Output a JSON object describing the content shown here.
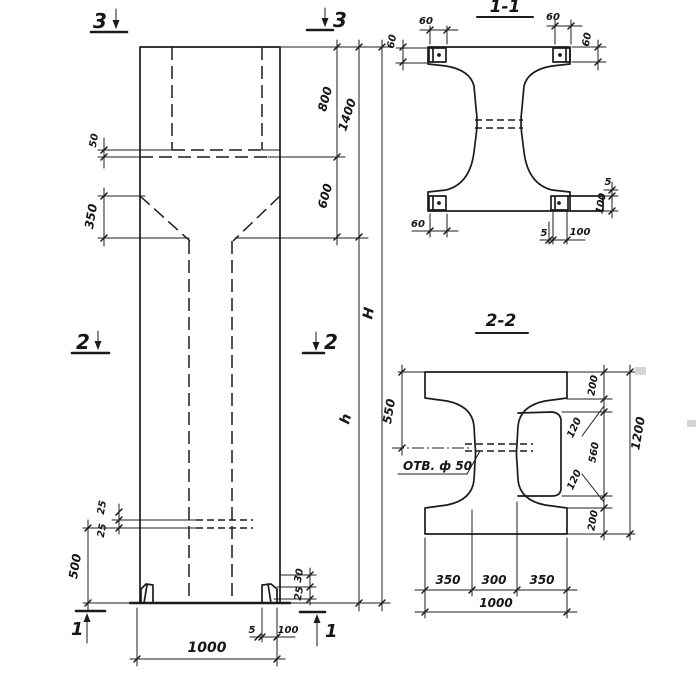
{
  "mv": {
    "m3l": "3",
    "m3r": "3",
    "m2l": "2",
    "m2r": "2",
    "m1l": "1",
    "m1r": "1",
    "d50": "50",
    "d350": "350",
    "d25a": "25",
    "d25b": "25",
    "d500": "500",
    "d800": "800",
    "d600": "600",
    "d1400": "1400",
    "dH": "H",
    "dh": "h",
    "d30": "30",
    "d25c": "25",
    "d5": "5",
    "d100": "100",
    "d1000": "1000"
  },
  "s11": {
    "title": "1-1",
    "d60tlh": "60",
    "d60tlv": "60",
    "d60trh": "60",
    "d60trv": "60",
    "d60bl": "60",
    "d5r": "5",
    "d100r": "100",
    "d5b": "5",
    "d100b": "100"
  },
  "s22": {
    "title": "2-2",
    "hole": "ОТВ. ф 50",
    "d550": "550",
    "d200t": "200",
    "d120t": "120",
    "d560": "560",
    "d120b": "120",
    "d200b": "200",
    "d1200": "1200",
    "db350l": "350",
    "db300": "300",
    "db350r": "350",
    "db1000": "1000"
  }
}
